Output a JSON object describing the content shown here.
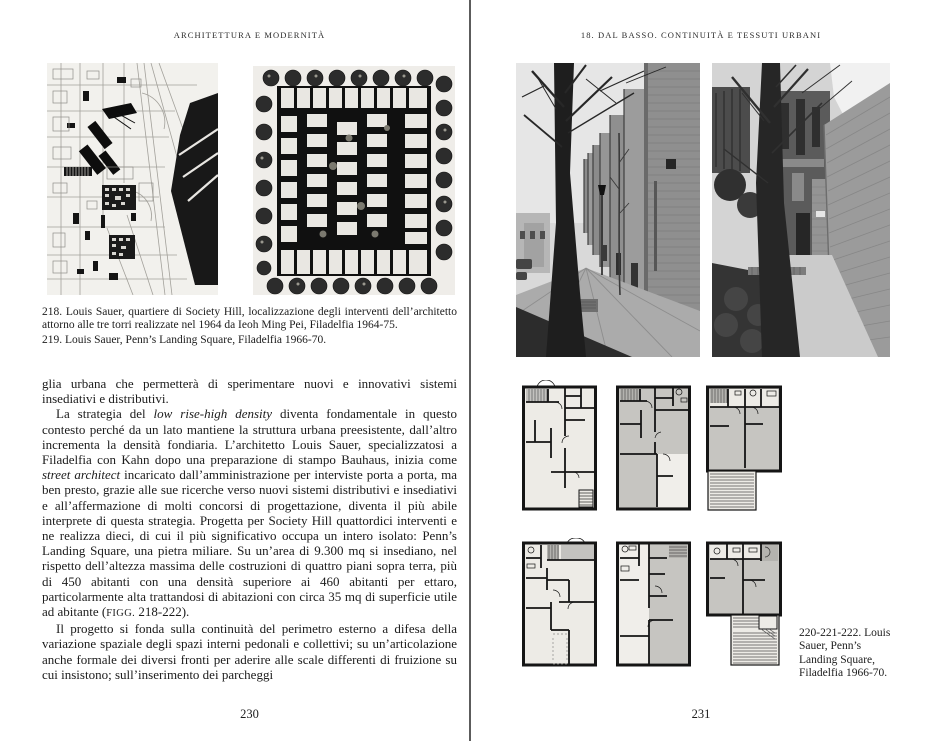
{
  "spread": {
    "left_page": {
      "header": "ARCHITETTURA E MODERNITÀ",
      "page_number": "230",
      "caption_218": "218. Louis Sauer, quartiere di Society Hill, localizzazione degli interventi dell’architetto attorno alle tre torri realizzate nel 1964 da Ieoh Ming Pei, Filadelfia 1964-75.",
      "caption_219": "219. Louis Sauer, Penn’s Landing Square, Filadelfia 1966-70.",
      "body_paragraphs": [
        {
          "indent": false,
          "segments": [
            {
              "t": "glia urbana che permetterà di sperimentare nuovi e innovativi sistemi insediativi e distributivi."
            }
          ]
        },
        {
          "indent": true,
          "segments": [
            {
              "t": "La strategia del "
            },
            {
              "t": "low rise-high density",
              "i": true
            },
            {
              "t": " diventa fondamentale in questo contesto perché da un lato mantiene la struttura urbana preesistente, dall’altro incrementa la densità fondiaria. L’architetto Louis Sauer, specializzatosi a Filadelfia con Kahn dopo una preparazione di stampo Bauhaus, inizia come "
            },
            {
              "t": "street architect",
              "i": true
            },
            {
              "t": " incaricato dall’amministrazione per interviste porta a porta, ma ben presto, grazie alle sue ricerche verso nuovi sistemi distributivi e insediativi e all’affermazione di molti concorsi di progettazione, diventa il più abile interprete di questa strategia. Progetta per Society Hill quattordici interventi e ne realizza dieci, di cui il più significativo occupa un intero isolato: Penn’s Landing Square, una pietra miliare. Su un’area di 9.300 mq si insediano, nel rispetto dell’altezza massima delle costruzioni di quattro piani sopra terra, più di 450 abitanti con una densità superiore ai 460 abitanti per ettaro, particolarmente alta trattandosi di abitazioni con circa 35 mq di superficie utile ad abitante ("
            },
            {
              "t": "FIGG.",
              "sc": true
            },
            {
              "t": " 218-222)."
            }
          ]
        },
        {
          "indent": true,
          "segments": [
            {
              "t": "Il progetto si fonda sulla continuità del perimetro esterno a difesa della variazione spaziale degli spazi interni pedonali e collettivi; su un’articolazione anche formale dei diversi fronti per aderire alle scale differenti di fruizione su cui insistono; sull’inserimento dei parcheggi"
            }
          ]
        }
      ]
    },
    "right_page": {
      "header": "18. DAL BASSO. CONTINUITÀ E TESSUTI URBANI",
      "page_number": "231",
      "caption_220_222": "220-221-222. Louis Sauer, Penn’s Landing Square, Filadelfia 1966-70."
    },
    "figures": {
      "fig_218": "society-hill-map",
      "fig_219": "penns-landing-site-plan",
      "fig_220": "street-photo",
      "fig_221": "walkway-photo",
      "fig_222": "apartment-floor-plans"
    },
    "colors": {
      "page_bg": "#ffffff",
      "ink": "#1c1c1c",
      "divider": "#5c5c5c",
      "scan_bg": "#f2f1ed"
    }
  }
}
